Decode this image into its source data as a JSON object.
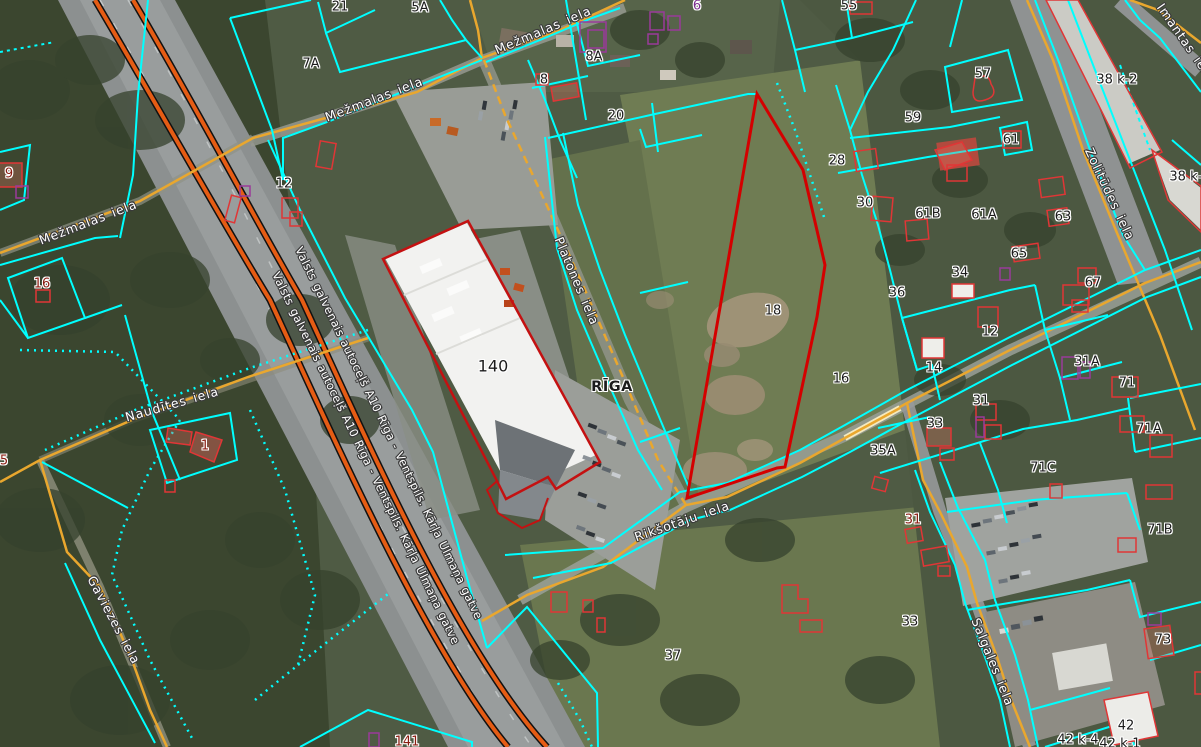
{
  "map": {
    "city": "RĪGA",
    "colors": {
      "parcel_boundary": "#00ffff",
      "minor_road": "#e9a72e",
      "highway": "#e55c14",
      "selected_parcel": "#d40000",
      "building_outline": "#e03636",
      "unregistered_building_outline": "#9a3a9a",
      "label_default": "#1c1c1c",
      "label_red": "#8a1d12",
      "label_purple": "#7c2d8e",
      "street_label": "#ffffff"
    },
    "streets": [
      {
        "id": "mezmalas-top",
        "text": "Mežmalas iela"
      },
      {
        "id": "mezmalas-upper",
        "text": "Mežmalas iela"
      },
      {
        "id": "mezmalas-left",
        "text": "Mežmalas iela"
      },
      {
        "id": "platones",
        "text": "Platones iela"
      },
      {
        "id": "zolitudes",
        "text": "Zolitūdes iela"
      },
      {
        "id": "imantas",
        "text": "Imantas iela"
      },
      {
        "id": "naudites",
        "text": "Naudītes iela"
      },
      {
        "id": "gaviezes",
        "text": "Gaviezes iela"
      },
      {
        "id": "riksotaju",
        "text": "Rikšotāju iela"
      },
      {
        "id": "salgales",
        "text": "Salgales iela"
      },
      {
        "id": "highway-a",
        "text": "Valsts galvenais autoceļš A10 Rīga - Ventspils. Kārļa Ulmaņa gatve"
      },
      {
        "id": "highway-b",
        "text": "Valsts galvenais autoceļš A10 Rīga - Ventspils. Kārļa Ulmaņa gatve"
      }
    ],
    "parcels": [
      {
        "text": "21"
      },
      {
        "text": "5A"
      },
      {
        "text": "7A"
      },
      {
        "text": "6"
      },
      {
        "text": "55"
      },
      {
        "text": "8A"
      },
      {
        "text": "8"
      },
      {
        "text": "20"
      },
      {
        "text": "57"
      },
      {
        "text": "59"
      },
      {
        "text": "38 k-2"
      },
      {
        "text": "38 k-2"
      },
      {
        "text": "28"
      },
      {
        "text": "30"
      },
      {
        "text": "61"
      },
      {
        "text": "61B"
      },
      {
        "text": "61A"
      },
      {
        "text": "63"
      },
      {
        "text": "65"
      },
      {
        "text": "34"
      },
      {
        "text": "67"
      },
      {
        "text": "36"
      },
      {
        "text": "12"
      },
      {
        "text": "12"
      },
      {
        "text": "14"
      },
      {
        "text": "31A"
      },
      {
        "text": "71"
      },
      {
        "text": "31"
      },
      {
        "text": "33"
      },
      {
        "text": "71A"
      },
      {
        "text": "35A"
      },
      {
        "text": "71C"
      },
      {
        "text": "31"
      },
      {
        "text": "33"
      },
      {
        "text": "71B"
      },
      {
        "text": "73"
      },
      {
        "text": "42"
      },
      {
        "text": "42 k-4"
      },
      {
        "text": "42 k-1"
      },
      {
        "text": "18"
      },
      {
        "text": "16"
      },
      {
        "text": "37"
      },
      {
        "text": "140"
      },
      {
        "text": "16"
      },
      {
        "text": "9"
      },
      {
        "text": "5"
      },
      {
        "text": "1"
      },
      {
        "text": "141"
      }
    ]
  }
}
